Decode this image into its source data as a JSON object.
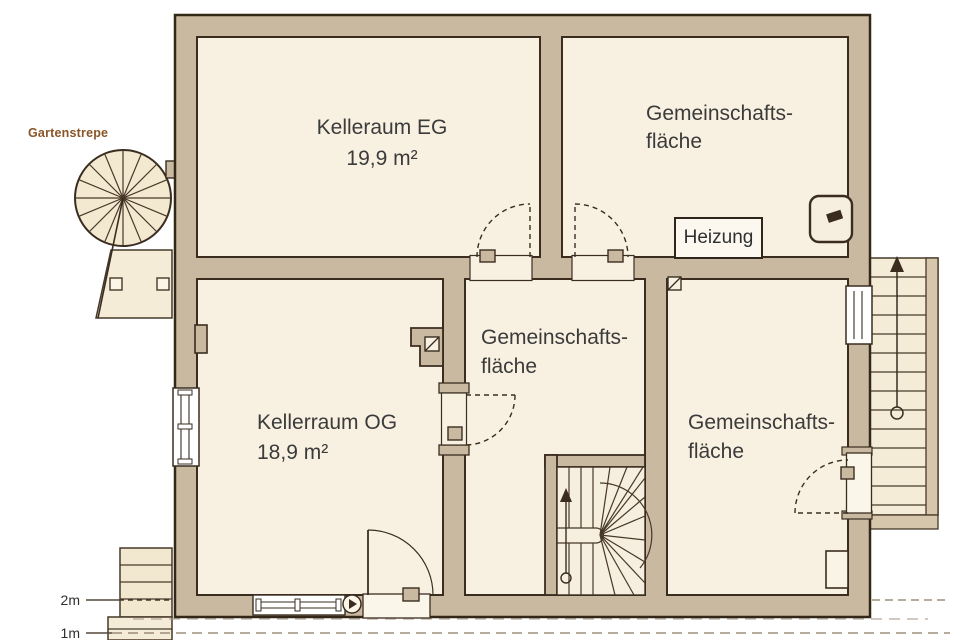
{
  "canvas": {
    "width": 960,
    "height": 640
  },
  "labels": {
    "garden_stair": "Gartenstrepe",
    "scale_2m": "2m",
    "scale_1m": "1m"
  },
  "rooms": {
    "eg": {
      "name": "Kelleraum EG",
      "area": "19,9 m²"
    },
    "og": {
      "name": "Kellerraum OG",
      "area": "18,9 m²"
    },
    "common_top": {
      "line1": "Gemeinschafts-",
      "line2": "fläche"
    },
    "common_mid": {
      "line1": "Gemeinschafts-",
      "line2": "fläche"
    },
    "common_right": {
      "line1": "Gemeinschafts-",
      "line2": "fläche"
    }
  },
  "equipment": {
    "heating": "Heizung"
  },
  "icons": {
    "spiral_staircase": "spiral-staircase-icon",
    "winder_staircase": "winder-staircase-icon",
    "straight_stairs": "straight-stairs-icon",
    "direction_arrow": "▲",
    "flue_marker": "⧄",
    "basin": "wall-basin-icon"
  },
  "colors": {
    "background": "#ffffff",
    "wall_fill": "#c9b9a0",
    "wall_outline": "#3a2d20",
    "room_fill": "#f8f1e2",
    "stair_fill": "#f2e7cf",
    "exterior_stair_fill": "#f5ecd8",
    "heating_box_fill": "#fcf8ef",
    "garden_label_text": "#8a5527",
    "scale_line": "#8b7a64",
    "text": "#3b3b3b"
  }
}
